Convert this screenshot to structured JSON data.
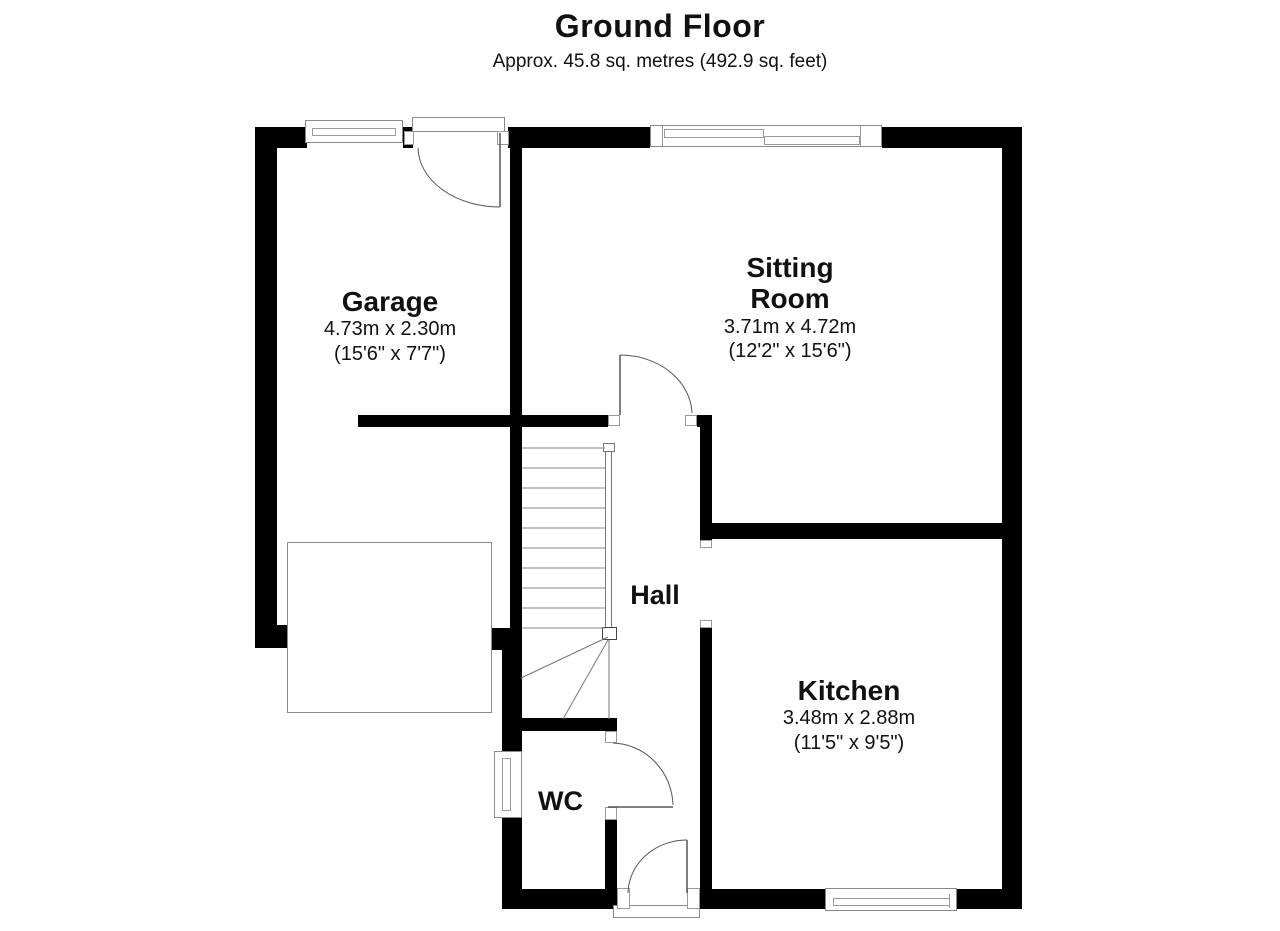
{
  "floor": {
    "title": "Ground Floor",
    "subtitle": "Approx. 45.8 sq. metres (492.9 sq. feet)"
  },
  "rooms": {
    "garage": {
      "name": "Garage",
      "metric": "4.73m x 2.30m",
      "imperial": "(15'6\" x 7'7\")"
    },
    "sitting_room": {
      "name_line1": "Sitting",
      "name_line2": "Room",
      "metric": "3.71m x 4.72m",
      "imperial": "(12'2\" x 15'6\")"
    },
    "hall": {
      "name": "Hall"
    },
    "kitchen": {
      "name": "Kitchen",
      "metric": "3.48m x 2.88m",
      "imperial": "(11'5\" x 9'5\")"
    },
    "wc": {
      "name": "WC"
    }
  },
  "colors": {
    "wall": "#000000",
    "line": "#7a7a7a",
    "background": "#ffffff",
    "text": "#111111"
  }
}
